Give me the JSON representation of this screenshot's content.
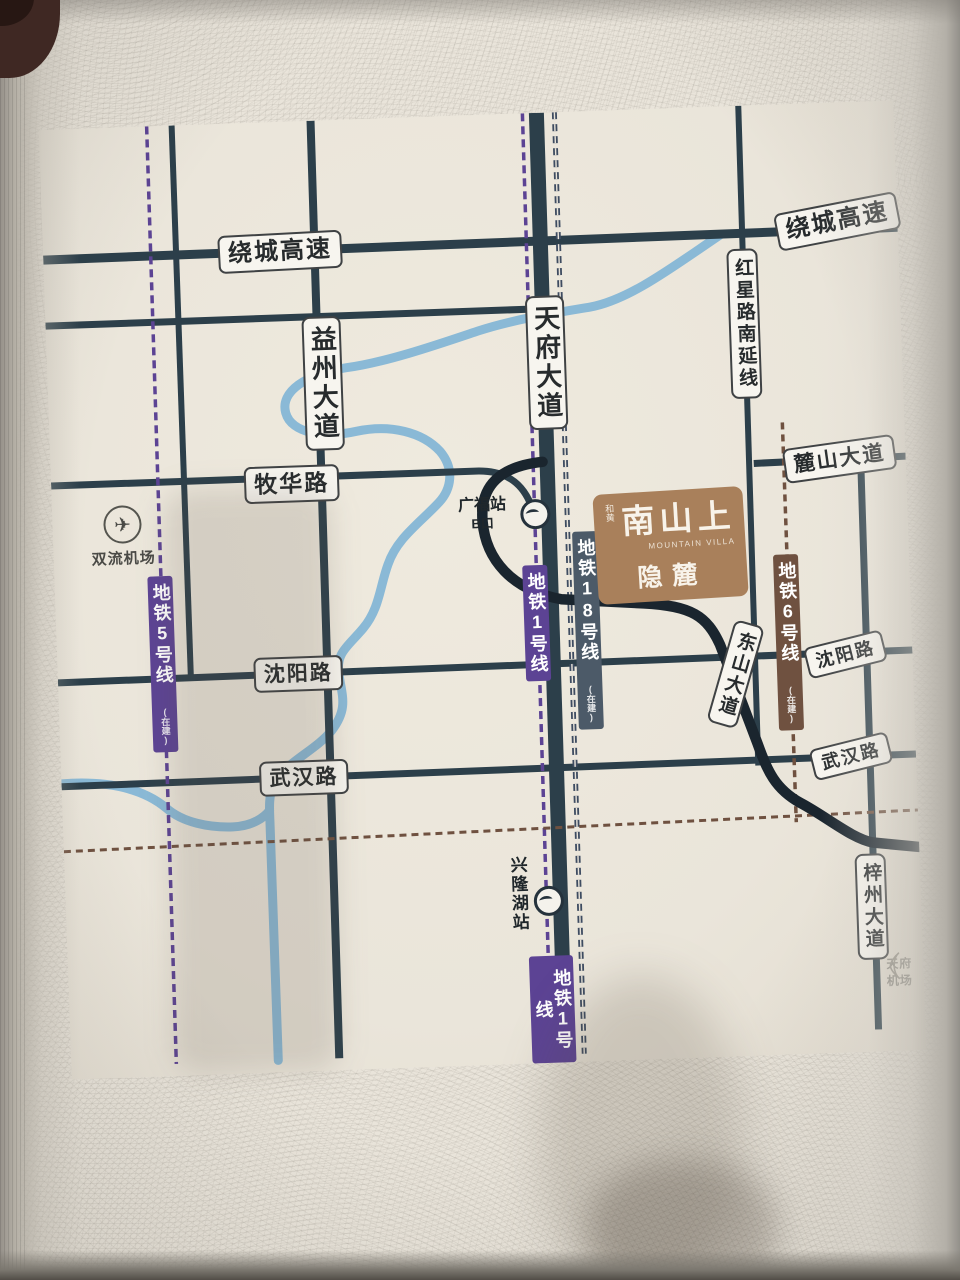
{
  "roads": {
    "ring_expressway_left": "绕城高速",
    "ring_expressway_right": "绕城高速",
    "yizhou_avenue": "益州大道",
    "tianfu_avenue": "天府大道",
    "hongxing_south_ext": "红星路南延线",
    "muhua_road": "牧华路",
    "lushan_avenue": "麓山大道",
    "shenyang_road_left": "沈阳路",
    "shenyang_road_right": "沈阳路",
    "wuhan_road_left": "武汉路",
    "wuhan_road_right": "武汉路",
    "dongshan_avenue": "东山大道",
    "zizhou_avenue": "梓州大道"
  },
  "metro": {
    "line5": {
      "label": "地铁5号线",
      "status": "(在建)"
    },
    "line1_mid": {
      "label": "地铁1号线"
    },
    "line1_south": {
      "label": "地铁1号线"
    },
    "line18": {
      "label": "地铁18号线",
      "status": "(在建)"
    },
    "line6": {
      "label": "地铁6号线",
      "status": "(在建)"
    }
  },
  "stations": {
    "guangfu": {
      "name": "广福站",
      "exit": "B口"
    },
    "xinglonghu": {
      "name": "兴隆湖站"
    }
  },
  "landmarks": {
    "shuangliu_airport": "双流机场",
    "tianfu_airport": "天府机场"
  },
  "project": {
    "brand_prefix": "和黄",
    "brand_cn": "南山上",
    "brand_en": "MOUNTAIN VILLA",
    "name": "隐麓"
  },
  "colors": {
    "road": "#2c3f4a",
    "highlight_route": "#1a252e",
    "river": "#8ab9d6",
    "metro_purple": "#5c4394",
    "metro_navy": "#3e4c61",
    "metro_brown": "#6f5140",
    "project_bg": "#a9805b",
    "paper": "#ece8de"
  }
}
